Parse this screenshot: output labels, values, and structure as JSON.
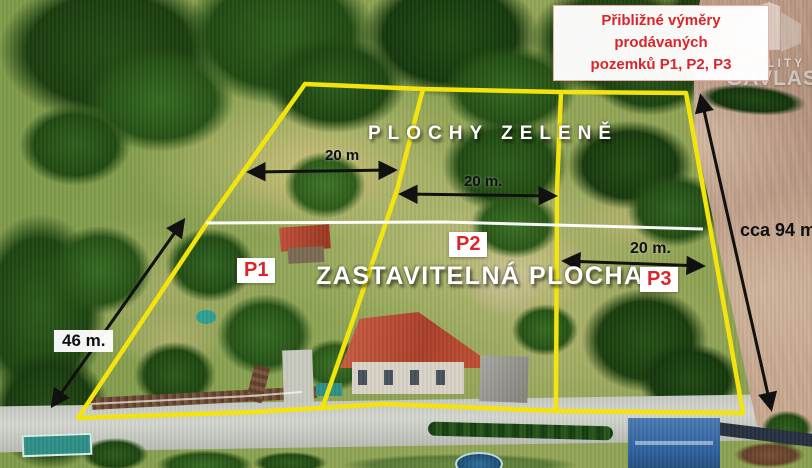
{
  "title": {
    "line1": "Přibližné výměry prodávaných",
    "line2": "pozemků P1, P2, P3"
  },
  "watermark": {
    "line1": "REALITY",
    "line2": "GAVLAS"
  },
  "zones": {
    "green_area_label": "PLOCHY ZELENĚ",
    "buildable_area_label": "ZASTAVITELNÁ PLOCHA"
  },
  "plots": [
    {
      "id": "P1"
    },
    {
      "id": "P2"
    },
    {
      "id": "P3"
    }
  ],
  "measurements": {
    "plot1_width": "20 m",
    "plot2_width": "20 m.",
    "plot3_width": "20 m.",
    "left_side": "46 m.",
    "right_side": "cca 94 m."
  },
  "colors": {
    "boundary_yellow": "#f2e40c",
    "divider_white": "#ffffff",
    "label_red": "#d9252b",
    "arrow_black": "#111111"
  }
}
